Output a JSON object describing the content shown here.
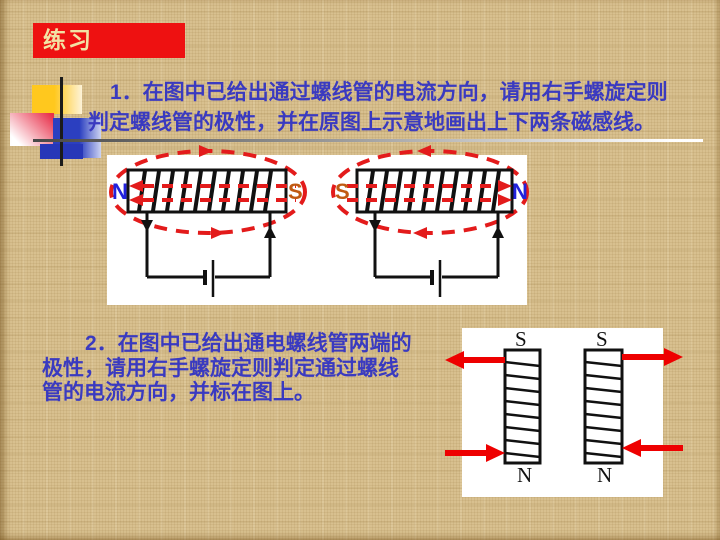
{
  "slide": {
    "title": "练习"
  },
  "problem1": {
    "line1": "1．在图中已给出通过螺线管的电流方向，请用右手螺旋定则",
    "line2": "判定螺线管的极性，并在原图上示意地画出上下两条磁感线。"
  },
  "problem2": {
    "line1": "2．在图中已给出通电螺线管两端的",
    "line2": "极性，请用右手螺旋定则判定通过螺线",
    "line3": "管的电流方向，并标在图上。"
  },
  "diagram1": {
    "left_solenoid": {
      "left_pole": "N",
      "right_pole": "S"
    },
    "right_solenoid": {
      "left_pole": "S",
      "right_pole": "N"
    }
  },
  "diagram2": {
    "left_coil": {
      "top_pole": "S",
      "bottom_pole": "N"
    },
    "right_coil": {
      "top_pole": "S",
      "bottom_pole": "N"
    }
  },
  "colors": {
    "background_tan": "#d8c08f",
    "title_box_red": "#ee1111",
    "title_text_yellow": "#f2e2a4",
    "problem_text_blue": "#3a3ac0",
    "north_pole_blue": "#2222dd",
    "south_pole_orange": "#c05a11",
    "field_line_red": "#e31b1b",
    "bold_arrow_red": "#ee0000",
    "circuit_black": "#111111",
    "panel_white": "#ffffff"
  }
}
